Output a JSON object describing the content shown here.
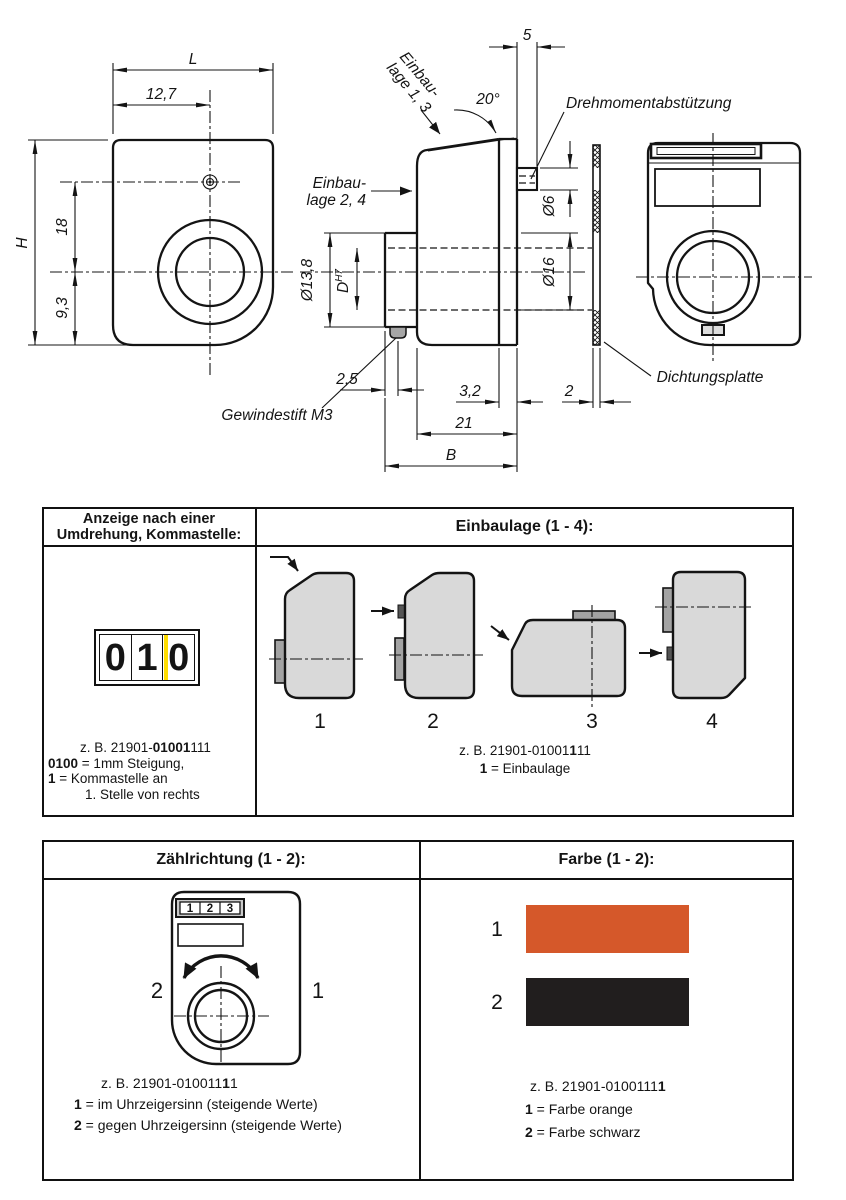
{
  "drawing": {
    "dims": {
      "L": "L",
      "w127": "12,7",
      "H": "H",
      "h18": "18",
      "h93": "9,3",
      "top5": "5",
      "angle": "20°",
      "d6": "Ø6",
      "d138": "Ø13,8",
      "dD": "D",
      "dDtol": "H7",
      "d16": "Ø16",
      "w25": "2,5",
      "w32": "3,2",
      "w2": "2",
      "w21": "21",
      "B": "B"
    },
    "labels": {
      "einbaulage13_line1": "Einbau-",
      "einbaulage13_line2": "lage 1, 3",
      "einbaulage24_line1": "Einbau-",
      "einbaulage24_line2": "lage 2, 4",
      "drehmomentabstuetzung": "Drehmomentabstützung",
      "dichtungsplatte": "Dichtungsplatte",
      "gewindestift": "Gewindestift M3"
    }
  },
  "table1": {
    "header_left_line1": "Anzeige nach einer",
    "header_left_line2": "Umdrehung, Kommastelle:",
    "header_right": "Einbaulage (1 - 4):",
    "counter": {
      "digit1": "0",
      "digit2": "1",
      "digit3": "0",
      "marker_color": "#FFDD00"
    },
    "caption_left": {
      "code_pre": "z. B. 21901-",
      "code_bold": "01001",
      "code_post": "111",
      "line2_bold": "0100",
      "line2_rest": " = 1mm Steigung,",
      "line3_bold": "1",
      "line3_rest": " = Kommastelle an",
      "line4": "1. Stelle von rechts"
    },
    "positions": {
      "p1": "1",
      "p2": "2",
      "p3": "3",
      "p4": "4"
    },
    "caption_right": {
      "code_pre": "z. B. 21901-01001",
      "code_bold": "1",
      "code_post": "11",
      "line2_bold": "1",
      "line2_rest": " = Einbaulage"
    }
  },
  "table2": {
    "header_left": "Zählrichtung (1 - 2):",
    "header_right": "Farbe (1 - 2):",
    "dial": {
      "digit1": "1",
      "digit2": "2",
      "digit3": "3",
      "ccw_label": "2",
      "cw_label": "1"
    },
    "caption_left": {
      "code_pre": "z. B. 21901-010011",
      "code_bold": "1",
      "code_post": "1",
      "line2_bold": "1",
      "line2_rest": " = im Uhrzeigersinn (steigende Werte)",
      "line3_bold": "2",
      "line3_rest": " = gegen Uhrzeigersinn (steigende Werte)"
    },
    "colors": {
      "label1": "1",
      "swatch1": "#D5582A",
      "label2": "2",
      "swatch2": "#211E1E"
    },
    "caption_right": {
      "code_pre": "z. B. 21901-0100111",
      "code_bold": "1",
      "line2_bold": "1",
      "line2_rest": " = Farbe orange",
      "line3_bold": "2",
      "line3_rest": " = Farbe schwarz"
    }
  }
}
